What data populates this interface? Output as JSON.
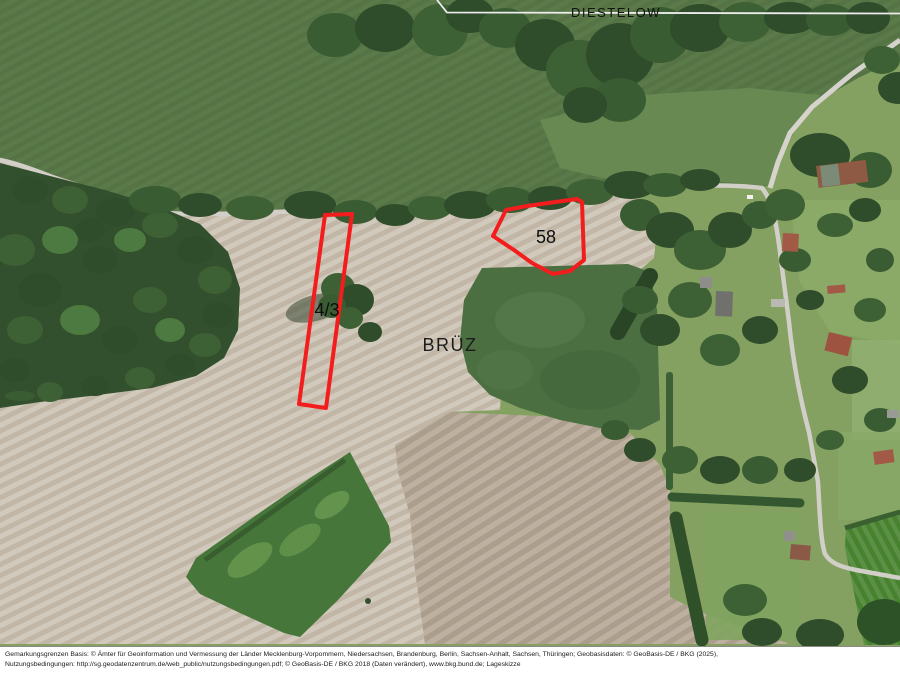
{
  "map": {
    "gemarkung_label": "DIESTELOW",
    "place_label": "BRÜZ",
    "outline_color": "#f41d1d",
    "parcels": [
      {
        "id": "58",
        "label": "58",
        "points": "493,236 506,210 527,206 577,199 582,202 584,260 570,271 553,274 532,263 514,250"
      },
      {
        "id": "4/3",
        "label": "4/3",
        "points": "325,215 352,214 326,408 299,404"
      }
    ]
  },
  "footer": {
    "line1": "Gemarkungsgrenzen Basis: © Ämter für Geoinformation und Vermessung der Länder Mecklenburg-Vorpommern, Niedersachsen, Brandenburg, Berlin, Sachsen-Anhalt, Sachsen, Thüringen; Geobasisdaten: © GeoBasis-DE / BKG (2025),",
    "line2": "Nutzungsbedingungen: http://sg.geodatenzentrum.de/web_public/nutzungsbedingungen.pdf; © GeoBasis-DE / BKG 2018 (Daten verändert), www.bkg.bund.de; Lageskizze"
  }
}
